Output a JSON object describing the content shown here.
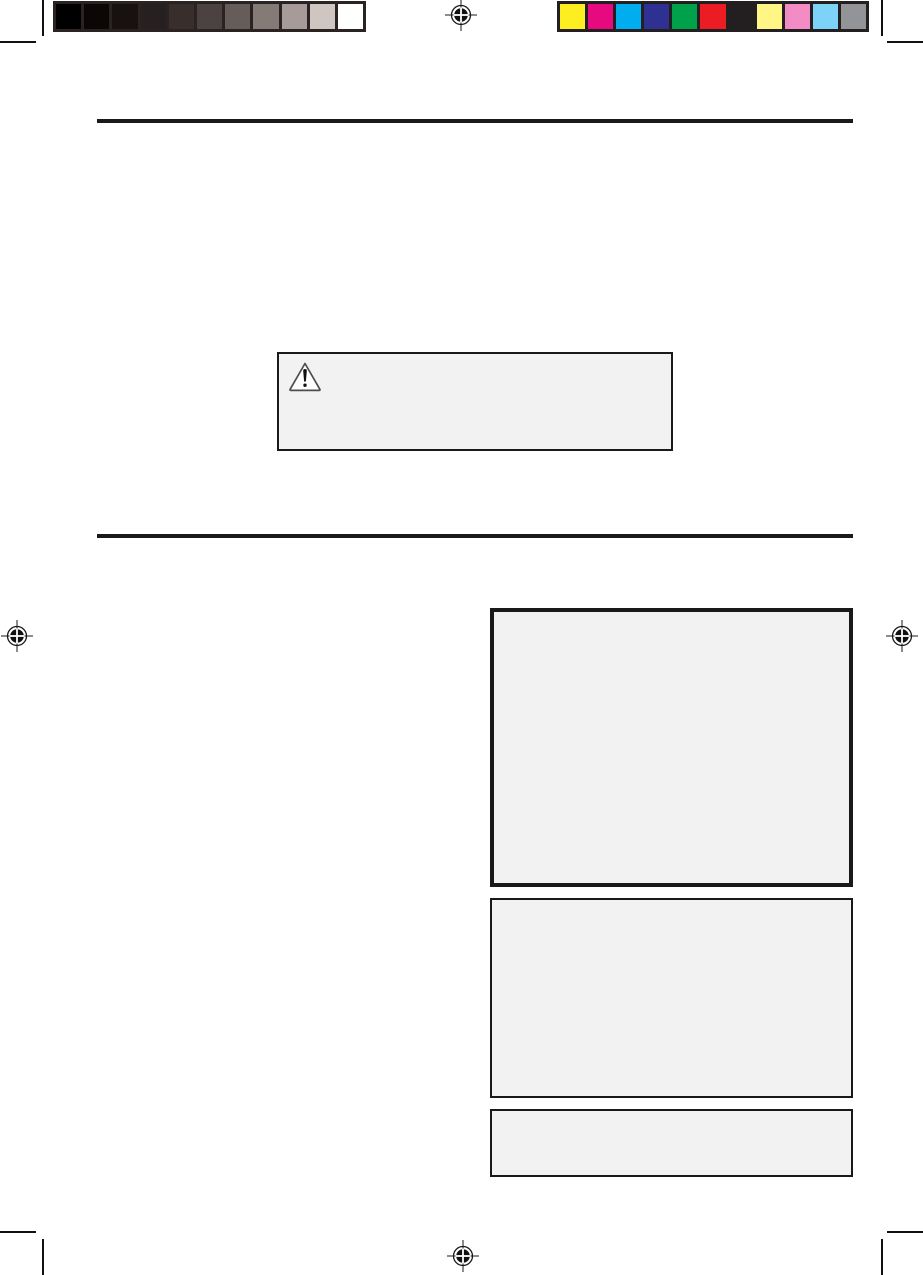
{
  "page": {
    "type": "print-proof-page",
    "background": "#ffffff"
  },
  "printer_marks": {
    "mark_color": "#111111",
    "crop_marks": [
      "top-left",
      "top-right",
      "bottom-left",
      "bottom-right"
    ],
    "registration_marks": [
      "top-center",
      "left-middle",
      "right-middle",
      "bottom-center"
    ]
  },
  "calibration_bars": {
    "grayscale": {
      "frame_color": "#2b2321",
      "swatches": [
        "#000000",
        "#0b0706",
        "#171110",
        "#262020",
        "#382e2c",
        "#4c4241",
        "#665c5a",
        "#847a76",
        "#a69b98",
        "#cfc5c1",
        "#ffffff"
      ]
    },
    "color": {
      "frame_color": "#231f20",
      "swatches": [
        "#fcee21",
        "#e6097f",
        "#00aeef",
        "#2e3192",
        "#00a14b",
        "#ec1c24",
        "#231f20",
        "#fff685",
        "#f38bc4",
        "#7cd3f7",
        "#929497"
      ]
    }
  },
  "content": {
    "divider_color": "#1a1a1a",
    "warning_box": {
      "background": "#f2f2f2",
      "border_color": "#1a1a1a",
      "icon": "warning-triangle",
      "text": ""
    },
    "panels": [
      {
        "id": "panel-top",
        "style": "thick-border",
        "background": "#f2f2f2",
        "text": ""
      },
      {
        "id": "panel-middle",
        "style": "thin-border",
        "background": "#f2f2f2",
        "text": ""
      },
      {
        "id": "panel-bottom",
        "style": "thin-border",
        "background": "#f2f2f2",
        "text": ""
      }
    ]
  }
}
